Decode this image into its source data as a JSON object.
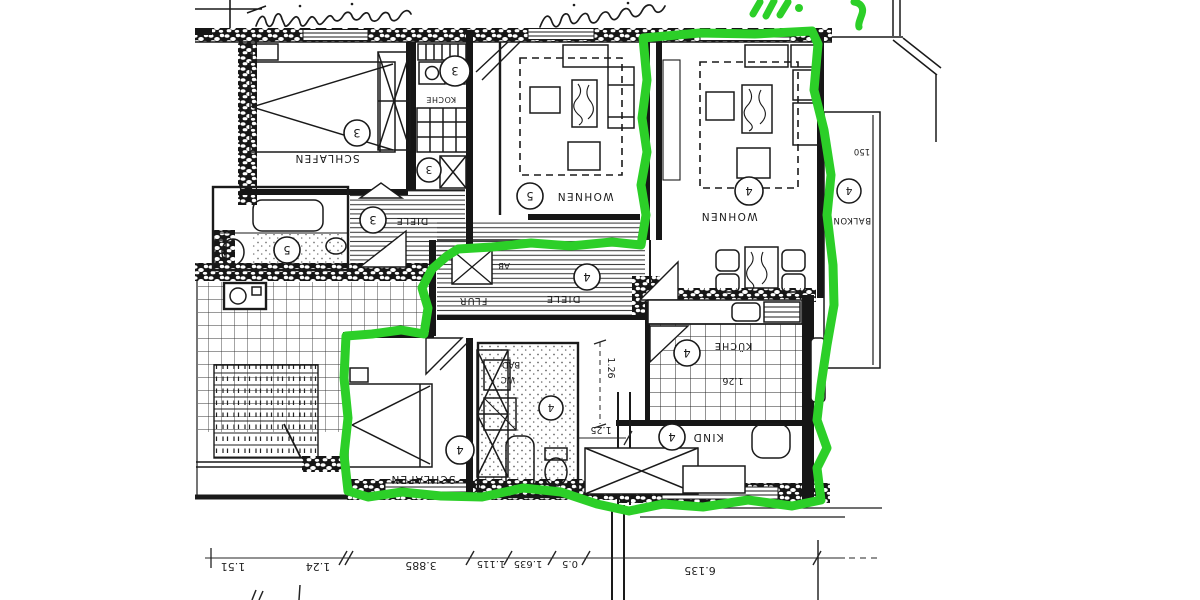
{
  "colors": {
    "paper": "#ffffff",
    "ink": "#1a1a1a",
    "marker_green": "#2ccf28"
  },
  "rooms": [
    {
      "id": "schlafen-3",
      "name": "SCHLAFEN",
      "number": "3"
    },
    {
      "id": "koche-3",
      "name": "KOCHE",
      "number": "3"
    },
    {
      "id": "ab-3",
      "number": "3"
    },
    {
      "id": "diele-3",
      "name": "DIELE",
      "number": "3"
    },
    {
      "id": "bad-5",
      "number": "5"
    },
    {
      "id": "wohnen-5",
      "name": "WOHNEN",
      "number": "5"
    },
    {
      "id": "wohnen-4",
      "name": "WOHNEN",
      "number": "4"
    },
    {
      "id": "balkon-4",
      "name": "BALKON",
      "number": "4"
    },
    {
      "id": "flur-4",
      "name": "FLUR"
    },
    {
      "id": "diele-4",
      "name": "DIELE",
      "number": "4"
    },
    {
      "id": "ab-4",
      "name": "AB"
    },
    {
      "id": "kueche-4",
      "name": "KÜCHE",
      "number": "4"
    },
    {
      "id": "bad-4",
      "name": "BAD",
      "name2": "WC",
      "number": "4"
    },
    {
      "id": "kind-4",
      "name": "KIND",
      "number": "4"
    },
    {
      "id": "schlafen-4",
      "name": "SCHLAFEN",
      "number": "4"
    }
  ],
  "dims": {
    "bottom_row": [
      "1.51",
      "1.24",
      "3.885",
      "1.115",
      "1.635",
      "0.5",
      "6.135"
    ],
    "corridor_vertical": "1.26",
    "kueche": "1.26",
    "kind": "1.25",
    "balkon": "150"
  }
}
